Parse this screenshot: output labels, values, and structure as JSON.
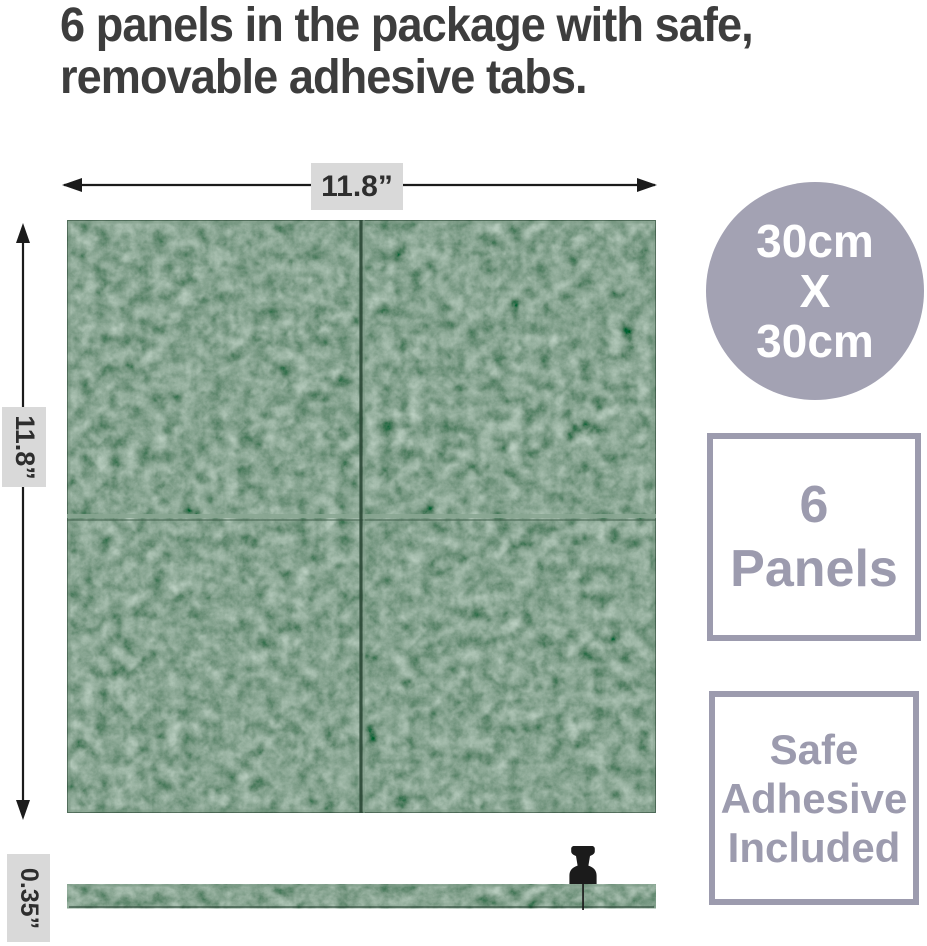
{
  "title": {
    "line1": "6 panels in the package with safe,",
    "line2": "removable adhesive tabs."
  },
  "dimensions": {
    "width": "11.8”",
    "height": "11.8”",
    "thickness": "0.35”"
  },
  "size_badge": {
    "line1": "30cm",
    "line2": "X",
    "line3": "30cm"
  },
  "count_badge": {
    "line1": "6",
    "line2": "Panels"
  },
  "adhesive_badge": {
    "line1": "Safe",
    "line2": "Adhesive",
    "line3": "Included"
  },
  "icons": {
    "width_arrow": "double-headed-arrow",
    "height_arrow": "double-headed-arrow",
    "pushpin": "pushpin"
  },
  "colors": {
    "title_text": "#3d3d3d",
    "ink": "#1b1b1b",
    "label_bg": "#d9d9d9",
    "label_text": "#2e2e2e",
    "felt_light": "#7e9c88",
    "felt_dark": "#2b4836",
    "circle_fill": "#a3a2b3",
    "badge_accent": "#9c9bae",
    "white": "#ffffff"
  }
}
